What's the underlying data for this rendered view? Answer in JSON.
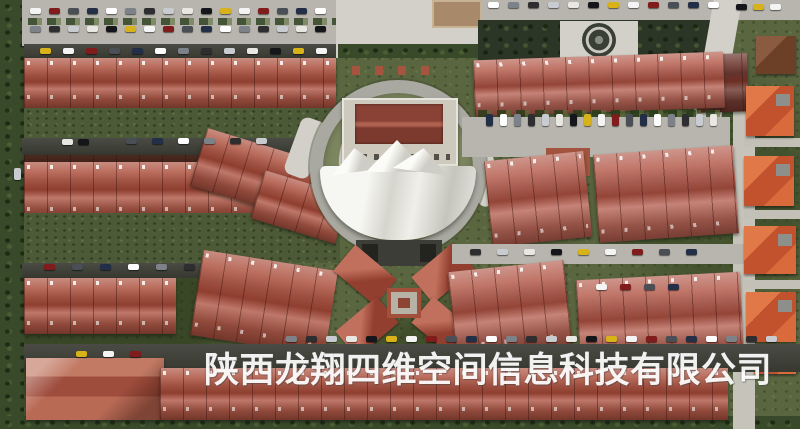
{
  "watermark": {
    "text": "陕西龙翔四维空间信息科技有限公司"
  },
  "scene": {
    "type": "aerial-photo",
    "colors": {
      "vegetation": "#5a6640",
      "courtyard": "#4d5a37",
      "roof_red": "#b05a49",
      "roof_pink": "#b96759",
      "villa_orange": "#d2643e",
      "asphalt_dark": "#3e3f38",
      "road_light": "#b7b5ad",
      "plaza": "#d2d0c8",
      "ring_road": "#a9a8a1",
      "tent_white": "#efefe9",
      "watermark": "#ffffff"
    },
    "car_palette": [
      "#f4f4f4",
      "#15161a",
      "#c8ccd0",
      "#7d8288",
      "#232f47",
      "#801c1c",
      "#d7b219",
      "#e9e7e1",
      "#2e2e31",
      "#ffffff",
      "#4a4e55"
    ],
    "car_rows": [
      {
        "x": 30,
        "y": 8,
        "count": 16,
        "gap": 19,
        "vert": false
      },
      {
        "x": 30,
        "y": 26,
        "count": 16,
        "gap": 19,
        "vert": false
      },
      {
        "x": 40,
        "y": 48,
        "count": 13,
        "gap": 23,
        "vert": false
      },
      {
        "x": 488,
        "y": 2,
        "count": 12,
        "gap": 20,
        "vert": false
      },
      {
        "x": 736,
        "y": 4,
        "count": 3,
        "gap": 17,
        "vert": false
      },
      {
        "x": 486,
        "y": 114,
        "count": 17,
        "gap": 14,
        "vert": true
      },
      {
        "x": 62,
        "y": 139,
        "count": 2,
        "gap": 16,
        "vert": false
      },
      {
        "x": 126,
        "y": 138,
        "count": 6,
        "gap": 26,
        "vert": false
      },
      {
        "x": 14,
        "y": 168,
        "count": 1,
        "gap": 0,
        "vert": true
      },
      {
        "x": 44,
        "y": 264,
        "count": 6,
        "gap": 28,
        "vert": false
      },
      {
        "x": 470,
        "y": 249,
        "count": 9,
        "gap": 27,
        "vert": false
      },
      {
        "x": 596,
        "y": 284,
        "count": 4,
        "gap": 24,
        "vert": false
      },
      {
        "x": 286,
        "y": 336,
        "count": 25,
        "gap": 20,
        "vert": false
      },
      {
        "x": 76,
        "y": 351,
        "count": 3,
        "gap": 27,
        "vert": false
      }
    ]
  }
}
